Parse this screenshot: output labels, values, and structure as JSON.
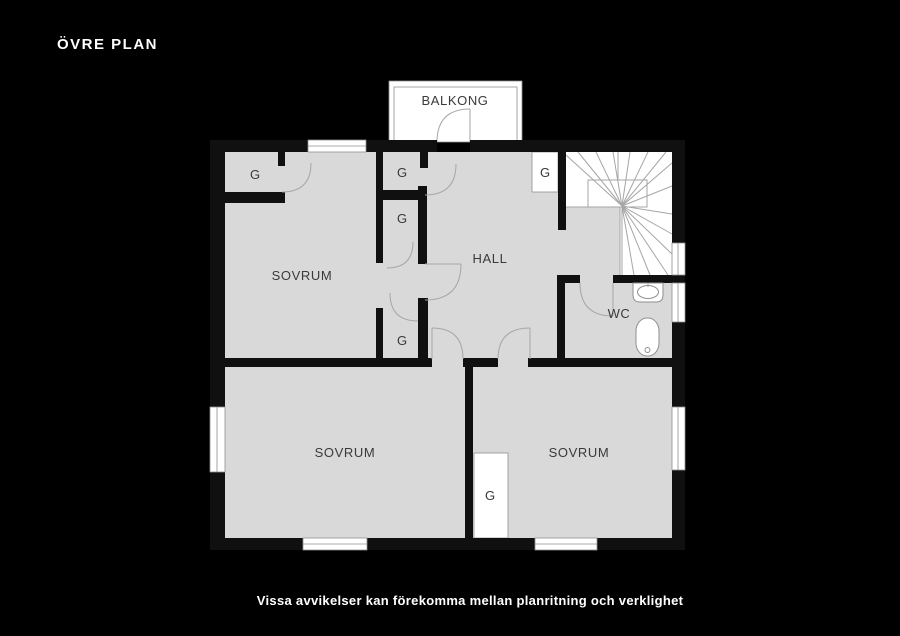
{
  "title": "ÖVRE PLAN",
  "caption": "Vissa avvikelser kan förekomma mellan planritning och verklighet",
  "floorplan": {
    "balcony_label": "BALKONG",
    "rooms": {
      "bedroom_top": "SOVRUM",
      "hall": "HALL",
      "wc": "WC",
      "bedroom_bottom_left": "SOVRUM",
      "bedroom_bottom_right": "SOVRUM"
    },
    "closets": {
      "top_left": "G",
      "mid_top": "G",
      "mid_second": "G",
      "mid_bottom": "G",
      "by_stairs": "G",
      "bedroom_right": "G"
    }
  },
  "colors": {
    "background": "#000000",
    "floor": "#d9d9d9",
    "wall": "#101010",
    "white": "#ffffff",
    "line": "#a6a6a6",
    "text": "#3a3a3a",
    "title_text": "#ffffff"
  }
}
